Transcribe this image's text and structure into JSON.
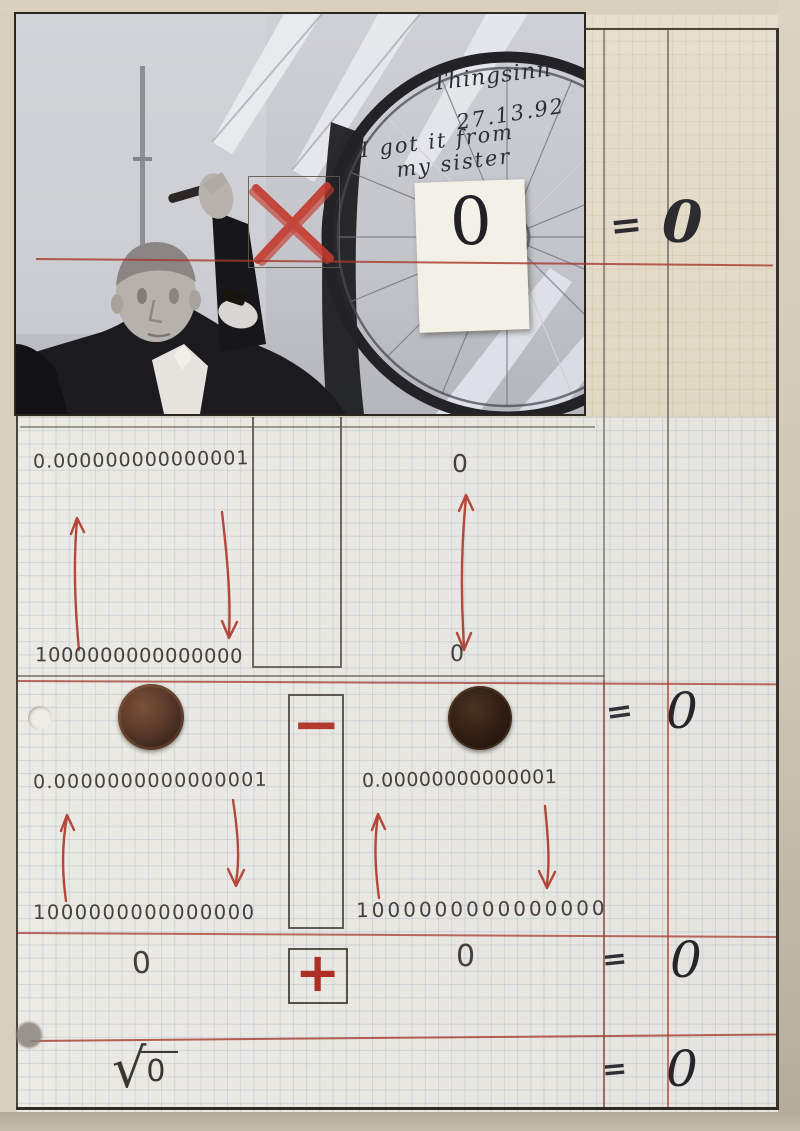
{
  "colors": {
    "red_ink": "#b2473a",
    "pencil": "#6f675e",
    "marker_black": "#26262a",
    "paper_cream": "#e5dccb",
    "paper_grid": "#eae9e4"
  },
  "photo": {
    "annotation_line1": "Thingsinn",
    "annotation_line2": "27.13.92",
    "annotation_line3": "I got it from",
    "annotation_line4": "my sister",
    "card_value": "0"
  },
  "equation_top": {
    "equals": "=",
    "result": "0"
  },
  "section_tiny_vs_huge": {
    "tiny": "0.000000000000001",
    "huge": "1000000000000000",
    "zero_top": "0",
    "zero_bottom": "0"
  },
  "section_coins": {
    "equals": "=",
    "result": "0",
    "minus_sign": "−",
    "left_tiny": "0.0000000000000001",
    "left_huge": "1000000000000000",
    "right_tiny": "0.00000000000001",
    "right_huge": "1000000000000000"
  },
  "section_addition": {
    "zero_left": "0",
    "plus_sign": "+",
    "zero_right": "0",
    "equals": "=",
    "result": "0"
  },
  "section_sqrt": {
    "radical": "√",
    "radicand": "0",
    "equals": "=",
    "result": "0"
  }
}
